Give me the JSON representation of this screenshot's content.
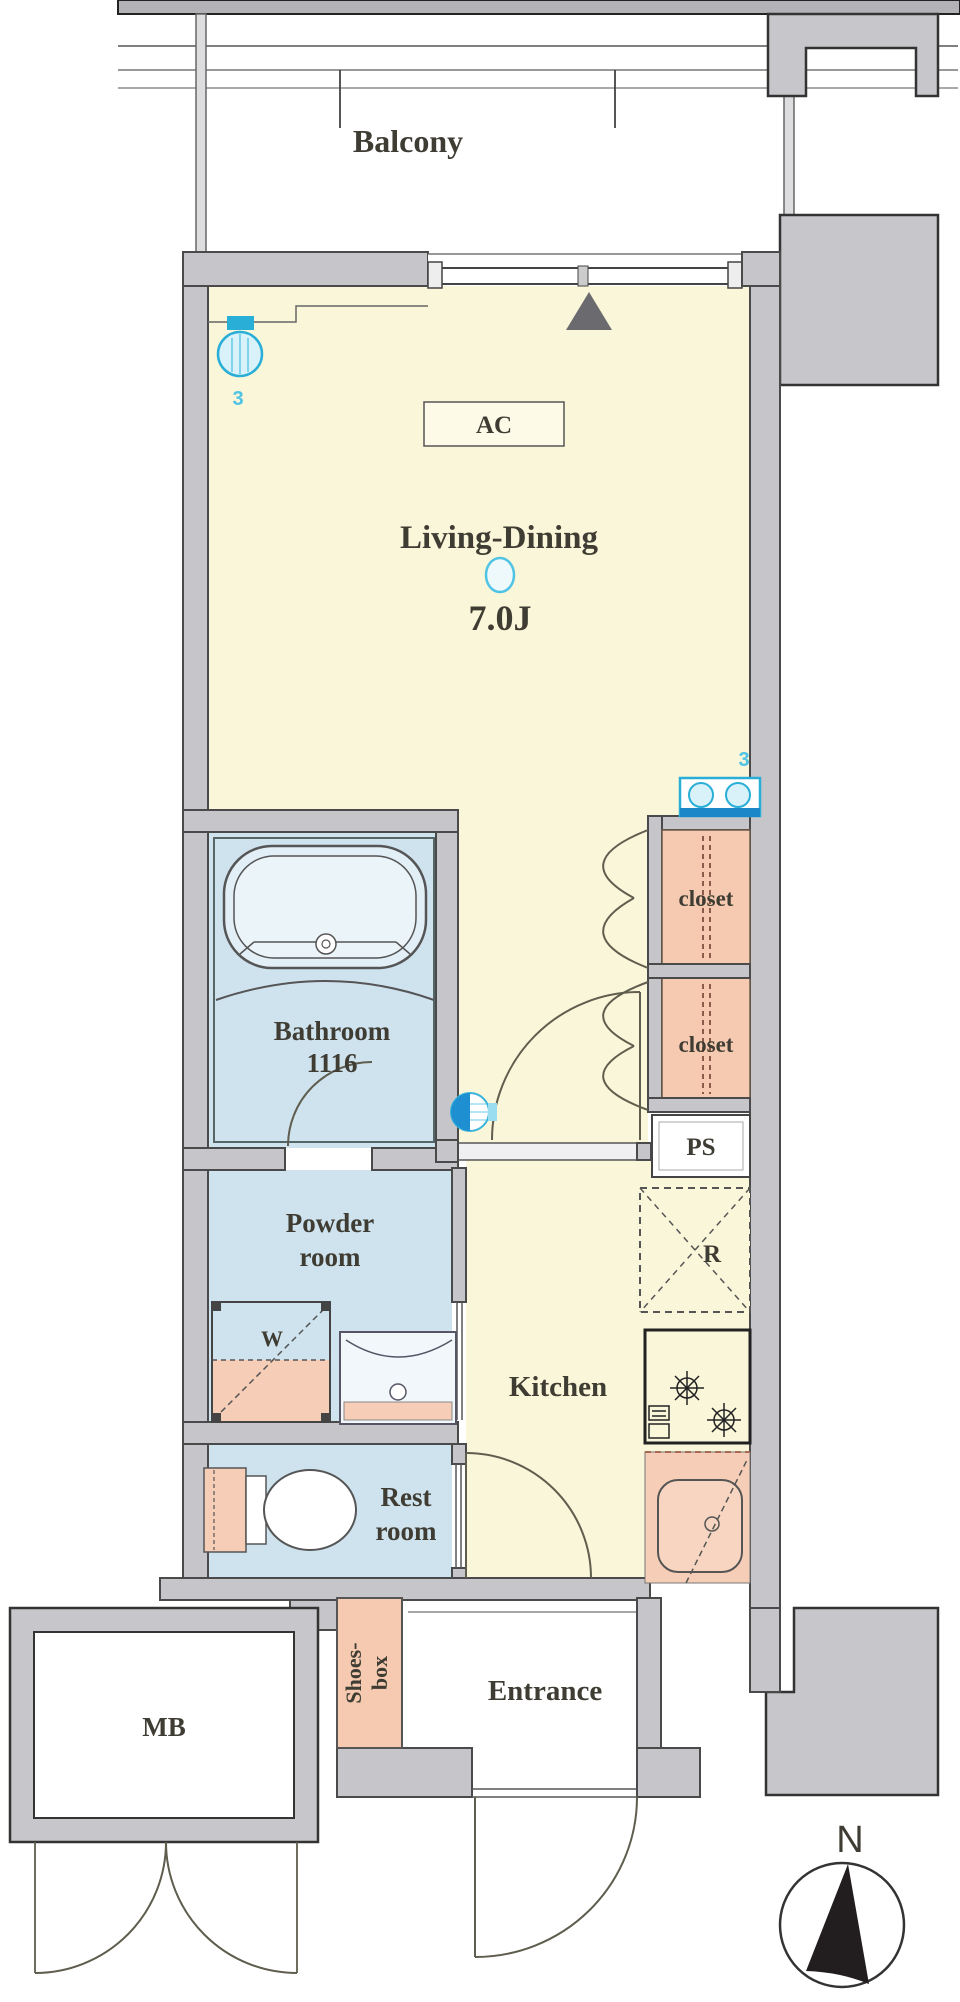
{
  "plan": {
    "balcony": {
      "label": "Balcony"
    },
    "living_dining": {
      "label": "Living-Dining",
      "size": "7.0J"
    },
    "ac": {
      "label": "AC"
    },
    "closet_upper": {
      "label": "closet"
    },
    "closet_lower": {
      "label": "closet"
    },
    "pipe_space": {
      "label": "PS"
    },
    "bathroom": {
      "label": "Bathroom",
      "size": "1116"
    },
    "powder_room": {
      "line1": "Powder",
      "line2": "room"
    },
    "washer": {
      "label": "W"
    },
    "refrigerator": {
      "label": "R"
    },
    "rest_room": {
      "line1": "Rest",
      "line2": "room"
    },
    "kitchen": {
      "label": "Kitchen"
    },
    "shoes_box": {
      "line1": "Shoes-",
      "line2": "box"
    },
    "entrance": {
      "label": "Entrance"
    },
    "meter_box": {
      "label": "MB"
    },
    "compass": {
      "label": "N"
    },
    "annotations": {
      "living_light_count": "3",
      "closet_light_count": "3"
    },
    "colors": {
      "floor_yellow": "#faf6d9",
      "floor_blue": "#cfe3ef",
      "fixture_salmon": "#f5cab0",
      "wall_gray": "#c6c6ca",
      "accent_cyan": "#2bb3dc",
      "outline": "#4a4a4a"
    }
  }
}
